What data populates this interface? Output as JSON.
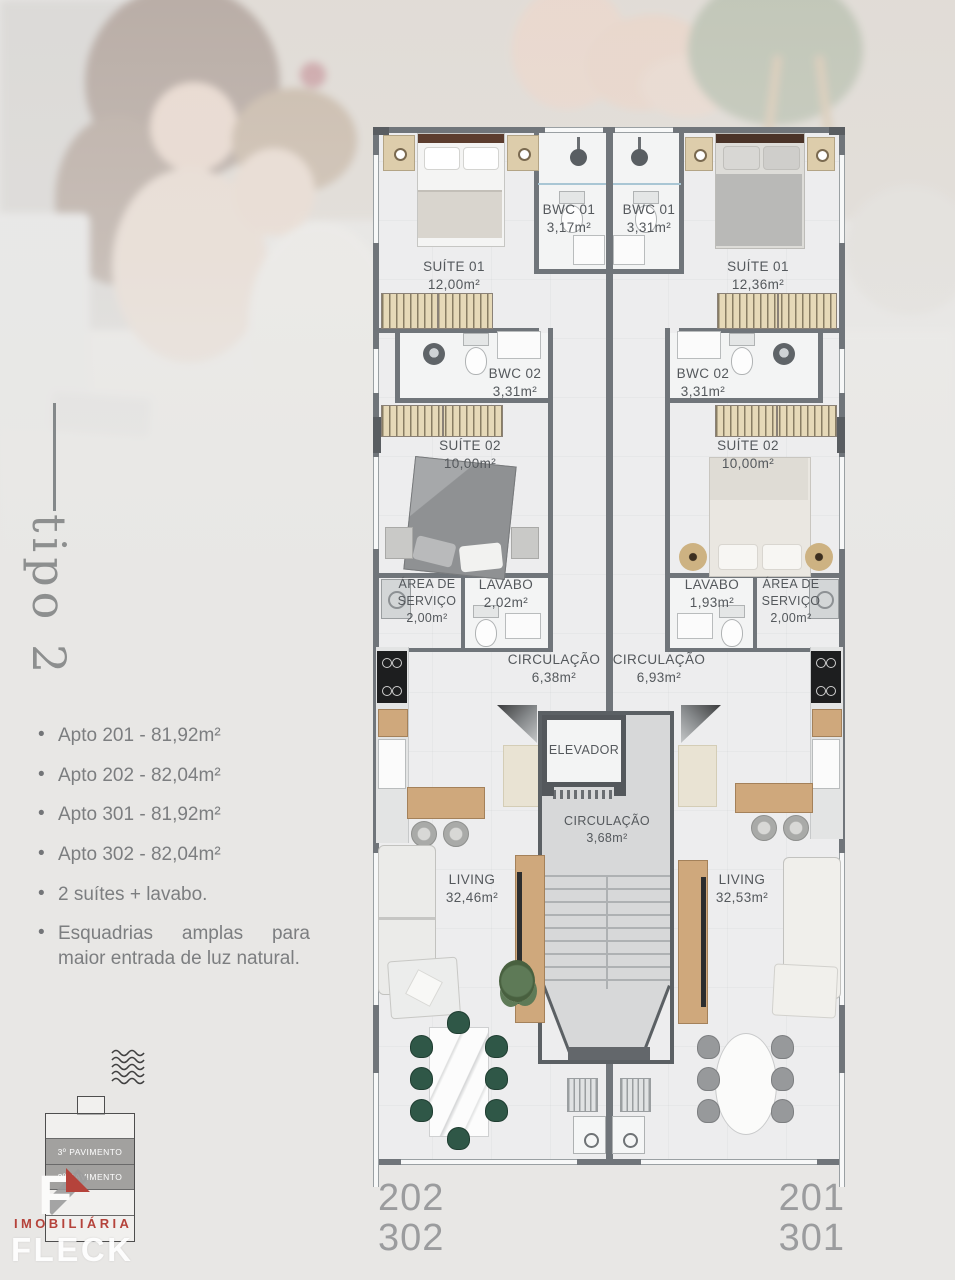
{
  "sidebar": {
    "title": "tipo 2",
    "bullets": [
      "Apto 201 - 81,92m²",
      "Apto 202 - 82,04m²",
      "Apto 301 - 81,92m²",
      "Apto 302 - 82,04m²",
      "2 suítes + lavabo.",
      "Esquadrias amplas para maior entrada de luz natural."
    ]
  },
  "plan": {
    "left_unit": {
      "suite01": {
        "name": "SUÍTE 01",
        "area": "12,00m²"
      },
      "bwc01": {
        "name": "BWC 01",
        "area": "3,17m²"
      },
      "bwc02": {
        "name": "BWC 02",
        "area": "3,31m²"
      },
      "suite02": {
        "name": "SUÍTE 02",
        "area": "10,00m²"
      },
      "area_servico": {
        "line1": "ÁREA DE",
        "line2": "SERVIÇO",
        "area": "2,00m²"
      },
      "lavabo": {
        "name": "LAVABO",
        "area": "2,02m²"
      },
      "circulacao": {
        "name": "CIRCULAÇÃO",
        "area": "6,38m²"
      },
      "living": {
        "name": "LIVING",
        "area": "32,46m²"
      }
    },
    "right_unit": {
      "suite01": {
        "name": "SUÍTE 01",
        "area": "12,36m²"
      },
      "bwc01": {
        "name": "BWC 01",
        "area": "3,31m²"
      },
      "bwc02": {
        "name": "BWC 02",
        "area": "3,31m²"
      },
      "suite02": {
        "name": "SUÍTE 02",
        "area": "10,00m²"
      },
      "area_servico": {
        "line1": "ÁREA DE",
        "line2": "SERVIÇO",
        "area": "2,00m²"
      },
      "lavabo": {
        "name": "LAVABO",
        "area": "1,93m²"
      },
      "circulacao": {
        "name": "CIRCULAÇÃO",
        "area": "6,93m²"
      },
      "living": {
        "name": "LIVING",
        "area": "32,53m²"
      }
    },
    "core": {
      "elevator": "ELEVADOR",
      "circulacao": {
        "name": "CIRCULAÇÃO",
        "area": "3,68m²"
      }
    }
  },
  "footer": {
    "left_units": {
      "line1": "202",
      "line2": "302"
    },
    "right_units": {
      "line1": "201",
      "line2": "301"
    }
  },
  "branding": {
    "floors": {
      "floor3": "3º PAVIMENTO",
      "floor2": "2º PAVIMENTO"
    },
    "company_type": "IMOBILIÁRIA",
    "company_name": "FLECK",
    "accent_red": "#b5433b"
  },
  "colors": {
    "wall": "#70757a",
    "label": "#54585c",
    "floor": "#ededee"
  }
}
